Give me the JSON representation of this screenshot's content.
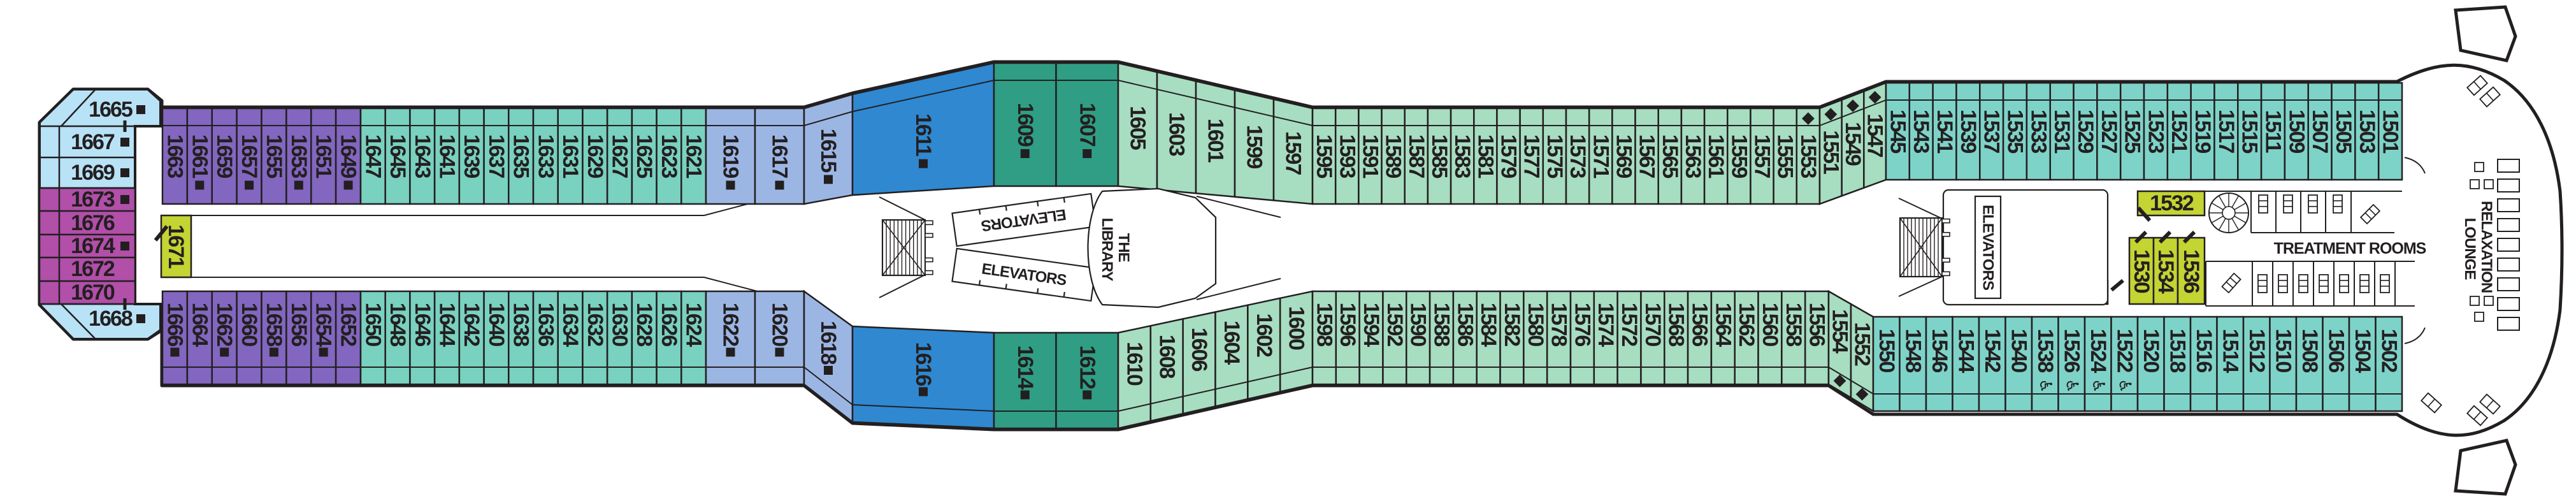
{
  "deck": {
    "labels": {
      "elevators": "ELEVATORS",
      "library_line1": "THE",
      "library_line2": "LIBRARY",
      "treatment_rooms": "TREATMENT ROOMS",
      "relaxation_line1": "RELAXATION",
      "relaxation_line2": "LOUNGE"
    },
    "colors": {
      "lightblue": "#b8e2f6",
      "magenta": "#b14fa9",
      "purple": "#8266bf",
      "teal": "#79d1c0",
      "periwinkle": "#9cb6e4",
      "darkblue": "#2f88d0",
      "darkteal": "#2f9e85",
      "lightgreen": "#a7ddc1",
      "tealbow": "#7ed3c9",
      "yellow": "#c3d433",
      "ink": "#231f20"
    },
    "stern_cabins": [
      {
        "n": "1665",
        "sq": true
      },
      {
        "n": "1667",
        "sq": true
      },
      {
        "n": "1669",
        "sq": true
      },
      {
        "n": "1673",
        "sq": true
      },
      {
        "n": "1676"
      },
      {
        "n": "1674",
        "sq": true
      },
      {
        "n": "1672"
      },
      {
        "n": "1670"
      },
      {
        "n": "1668",
        "sq": true
      }
    ],
    "spa_cabins": {
      "c1671": "1671",
      "c1528": "1528",
      "c1530": "1530",
      "c1532": "1532",
      "c1534": "1534",
      "c1536": "1536"
    },
    "rows": {
      "top": [
        {
          "color": "purple",
          "cabins": [
            {
              "n": "1663"
            },
            {
              "n": "1661",
              "sq": true
            },
            {
              "n": "1659"
            },
            {
              "n": "1657",
              "sq": true
            },
            {
              "n": "1655"
            },
            {
              "n": "1653",
              "sq": true
            },
            {
              "n": "1651"
            },
            {
              "n": "1649",
              "sq": true
            }
          ]
        },
        {
          "color": "teal",
          "cabins": [
            {
              "n": "1647"
            },
            {
              "n": "1645"
            },
            {
              "n": "1643"
            },
            {
              "n": "1641"
            },
            {
              "n": "1639"
            },
            {
              "n": "1637"
            },
            {
              "n": "1635"
            },
            {
              "n": "1633"
            },
            {
              "n": "1631"
            },
            {
              "n": "1629"
            },
            {
              "n": "1627"
            },
            {
              "n": "1625"
            },
            {
              "n": "1623"
            },
            {
              "n": "1621"
            }
          ]
        },
        {
          "color": "periwinkle",
          "cabins": [
            {
              "n": "1619",
              "sq": true
            },
            {
              "n": "1617",
              "sq": true
            }
          ]
        },
        {
          "color": "periwinkle",
          "cabins": [
            {
              "n": "1615",
              "sq": true
            }
          ]
        },
        {
          "color": "darkblue",
          "cabins": [
            {
              "n": "1611",
              "sq": true
            }
          ]
        },
        {
          "color": "darkteal",
          "cabins": [
            {
              "n": "1609",
              "sq": true
            },
            {
              "n": "1607",
              "sq": true
            }
          ]
        },
        {
          "color": "lightgreen",
          "cabins": [
            {
              "n": "1605"
            },
            {
              "n": "1603"
            },
            {
              "n": "1601"
            },
            {
              "n": "1599"
            },
            {
              "n": "1597"
            }
          ]
        },
        {
          "color": "lightgreen",
          "cabins": [
            {
              "n": "1595"
            },
            {
              "n": "1593"
            },
            {
              "n": "1591"
            },
            {
              "n": "1589"
            },
            {
              "n": "1587"
            },
            {
              "n": "1585"
            },
            {
              "n": "1583"
            },
            {
              "n": "1581"
            },
            {
              "n": "1579"
            },
            {
              "n": "1577"
            },
            {
              "n": "1575"
            },
            {
              "n": "1573"
            },
            {
              "n": "1571"
            },
            {
              "n": "1569"
            },
            {
              "n": "1567"
            },
            {
              "n": "1565"
            },
            {
              "n": "1563"
            },
            {
              "n": "1561"
            },
            {
              "n": "1559"
            },
            {
              "n": "1557"
            },
            {
              "n": "1555"
            },
            {
              "n": "1553",
              "dia": true
            }
          ]
        },
        {
          "color": "lightgreen",
          "cabins": [
            {
              "n": "1551",
              "dia": true
            },
            {
              "n": "1549",
              "dia": true
            },
            {
              "n": "1547",
              "dia": true
            }
          ]
        },
        {
          "color": "tealbow",
          "cabins": [
            {
              "n": "1545"
            },
            {
              "n": "1543"
            },
            {
              "n": "1541"
            },
            {
              "n": "1539"
            },
            {
              "n": "1537"
            },
            {
              "n": "1535"
            },
            {
              "n": "1533"
            },
            {
              "n": "1531"
            },
            {
              "n": "1529"
            },
            {
              "n": "1527"
            },
            {
              "n": "1525"
            },
            {
              "n": "1523"
            },
            {
              "n": "1521"
            },
            {
              "n": "1519"
            },
            {
              "n": "1517"
            },
            {
              "n": "1515"
            },
            {
              "n": "1511"
            },
            {
              "n": "1509"
            },
            {
              "n": "1507"
            },
            {
              "n": "1505"
            },
            {
              "n": "1503"
            },
            {
              "n": "1501"
            }
          ]
        }
      ],
      "bottom": [
        {
          "color": "purple",
          "cabins": [
            {
              "n": "1666",
              "sq": true
            },
            {
              "n": "1664"
            },
            {
              "n": "1662",
              "sq": true
            },
            {
              "n": "1660"
            },
            {
              "n": "1658",
              "sq": true
            },
            {
              "n": "1656"
            },
            {
              "n": "1654",
              "sq": true
            },
            {
              "n": "1652"
            }
          ]
        },
        {
          "color": "teal",
          "cabins": [
            {
              "n": "1650"
            },
            {
              "n": "1648"
            },
            {
              "n": "1646"
            },
            {
              "n": "1644"
            },
            {
              "n": "1642"
            },
            {
              "n": "1640"
            },
            {
              "n": "1638"
            },
            {
              "n": "1636"
            },
            {
              "n": "1634"
            },
            {
              "n": "1632"
            },
            {
              "n": "1630"
            },
            {
              "n": "1628"
            },
            {
              "n": "1626"
            },
            {
              "n": "1624"
            }
          ]
        },
        {
          "color": "periwinkle",
          "cabins": [
            {
              "n": "1622",
              "sq": true
            },
            {
              "n": "1620",
              "sq": true
            }
          ]
        },
        {
          "color": "periwinkle",
          "cabins": [
            {
              "n": "1618",
              "sq": true
            }
          ]
        },
        {
          "color": "darkblue",
          "cabins": [
            {
              "n": "1616",
              "sq": true
            }
          ]
        },
        {
          "color": "darkteal",
          "cabins": [
            {
              "n": "1614",
              "sq": true
            },
            {
              "n": "1612",
              "sq": true
            }
          ]
        },
        {
          "color": "lightgreen",
          "cabins": [
            {
              "n": "1610"
            },
            {
              "n": "1608"
            },
            {
              "n": "1606"
            },
            {
              "n": "1604"
            },
            {
              "n": "1602"
            },
            {
              "n": "1600"
            }
          ]
        },
        {
          "color": "lightgreen",
          "cabins": [
            {
              "n": "1598"
            },
            {
              "n": "1596"
            },
            {
              "n": "1594"
            },
            {
              "n": "1592"
            },
            {
              "n": "1590"
            },
            {
              "n": "1588"
            },
            {
              "n": "1586"
            },
            {
              "n": "1584"
            },
            {
              "n": "1582"
            },
            {
              "n": "1580"
            },
            {
              "n": "1578"
            },
            {
              "n": "1576"
            },
            {
              "n": "1574"
            },
            {
              "n": "1572"
            },
            {
              "n": "1570"
            },
            {
              "n": "1568"
            },
            {
              "n": "1566"
            },
            {
              "n": "1564"
            },
            {
              "n": "1562"
            },
            {
              "n": "1560"
            },
            {
              "n": "1558"
            },
            {
              "n": "1556"
            }
          ]
        },
        {
          "color": "lightgreen",
          "cabins": [
            {
              "n": "1554",
              "dia": true
            },
            {
              "n": "1552",
              "dia": true
            }
          ]
        },
        {
          "color": "tealbow",
          "cabins": [
            {
              "n": "1550"
            },
            {
              "n": "1548"
            },
            {
              "n": "1546"
            },
            {
              "n": "1544"
            },
            {
              "n": "1542"
            },
            {
              "n": "1540"
            },
            {
              "n": "1538",
              "wc": true
            },
            {
              "n": "1526",
              "wc": true
            },
            {
              "n": "1524",
              "wc": true
            },
            {
              "n": "1522",
              "wc": true
            },
            {
              "n": "1520"
            },
            {
              "n": "1518"
            },
            {
              "n": "1516"
            },
            {
              "n": "1514"
            },
            {
              "n": "1512"
            },
            {
              "n": "1510"
            },
            {
              "n": "1508"
            },
            {
              "n": "1506"
            },
            {
              "n": "1504"
            },
            {
              "n": "1502"
            }
          ]
        }
      ]
    }
  }
}
